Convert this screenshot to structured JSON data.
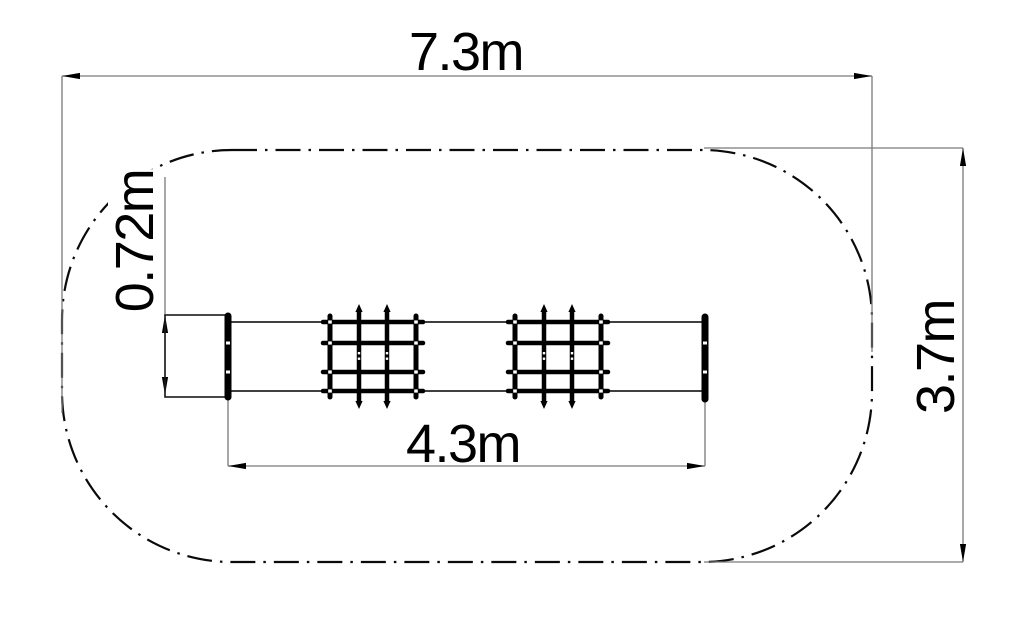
{
  "drawing": {
    "colors": {
      "background": "#ffffff",
      "linework": "#000000",
      "dimension_lines": "#7a7a7a"
    },
    "labels": {
      "overall_width": "7.3m",
      "overall_depth": "3.7m",
      "equipment_length": "4.3m",
      "equipment_width": "0.72m"
    }
  }
}
